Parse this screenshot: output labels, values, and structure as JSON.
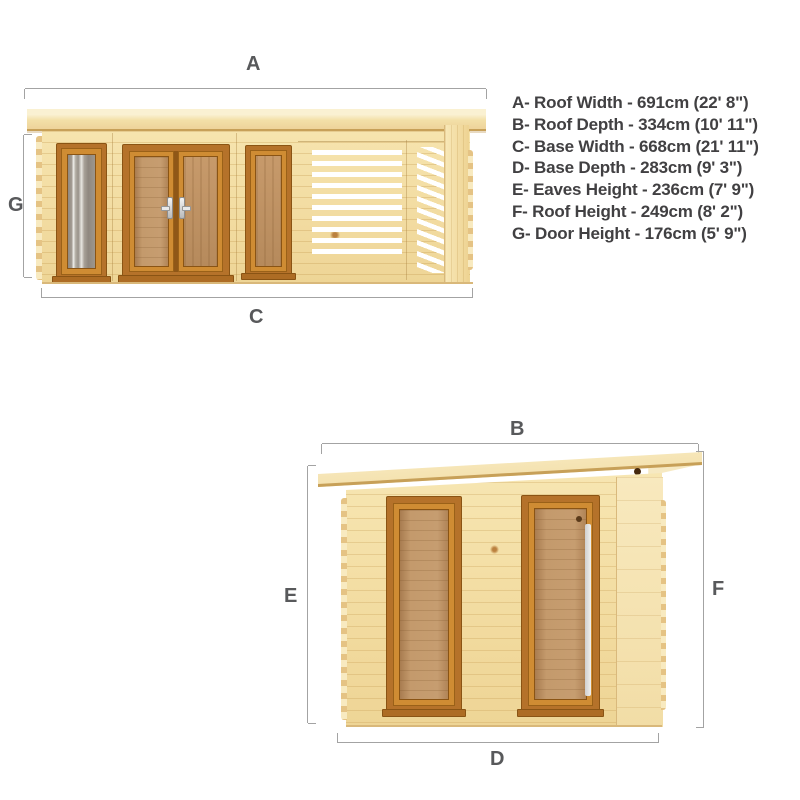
{
  "legend": {
    "items": [
      {
        "letter": "A",
        "name": "Roof Width",
        "cm": "691cm",
        "imperial": "22' 8\"",
        "text": "A- Roof Width - 691cm (22' 8\")"
      },
      {
        "letter": "B",
        "name": "Roof Depth",
        "cm": "334cm",
        "imperial": "10' 11\"",
        "text": "B- Roof Depth - 334cm (10' 11\")"
      },
      {
        "letter": "C",
        "name": "Base Width",
        "cm": "668cm",
        "imperial": "21' 11\"",
        "text": "C- Base Width - 668cm (21' 11\")"
      },
      {
        "letter": "D",
        "name": "Base Depth",
        "cm": "283cm",
        "imperial": "9' 3\"",
        "text": "D- Base Depth - 283cm (9' 3\")"
      },
      {
        "letter": "E",
        "name": "Eaves Height",
        "cm": "236cm",
        "imperial": "7' 9\"",
        "text": "E- Eaves Height - 236cm (7' 9\")"
      },
      {
        "letter": "F",
        "name": "Roof Height",
        "cm": "249cm",
        "imperial": "8' 2\"",
        "text": "F- Roof Height - 249cm (8' 2\")"
      },
      {
        "letter": "G",
        "name": "Door Height",
        "cm": "176cm",
        "imperial": "5' 9\"",
        "text": "G- Door Height - 176cm (5' 9\")"
      }
    ]
  },
  "front_view": {
    "dim_a": "A",
    "dim_c": "C",
    "dim_g": "G"
  },
  "side_view": {
    "dim_b": "B",
    "dim_d": "D",
    "dim_e": "E",
    "dim_f": "F"
  },
  "colors": {
    "wood_base": "#f3dfa6",
    "frame_orange": "#b5722a",
    "slat_gap": "#ffffff",
    "dimension_line": "#a3a3a3",
    "label_text": "#58595b",
    "legend_text": "#414042"
  }
}
